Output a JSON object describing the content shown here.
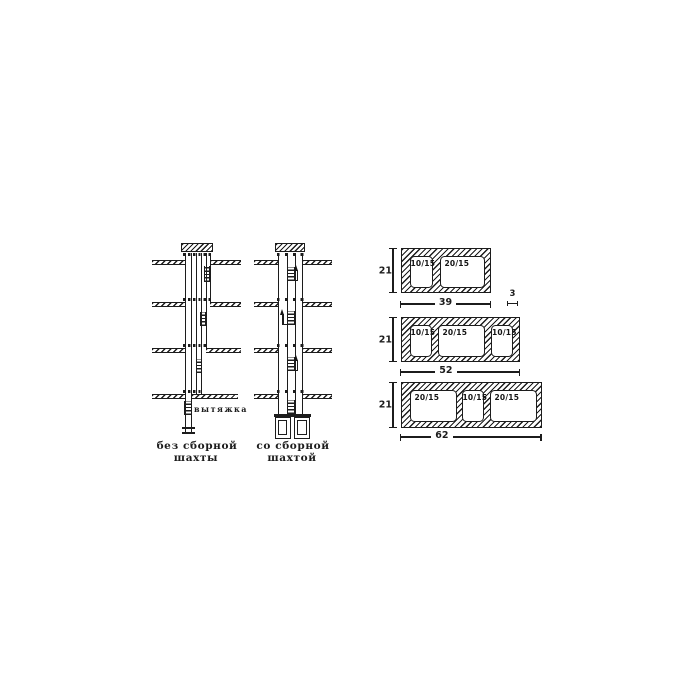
{
  "diagrams": {
    "left": {
      "exhaust_label": "вытяжка",
      "caption_line1": "без сборной",
      "caption_line2": "шахты"
    },
    "right": {
      "caption_line1": "со сборной",
      "caption_line2": "шахтой"
    }
  },
  "blocks": [
    {
      "height": "21",
      "width": "39",
      "cells": [
        "10/15",
        "20/15"
      ],
      "wall_dim": "3"
    },
    {
      "height": "21",
      "width": "52",
      "cells": [
        "10/15",
        "20/15",
        "10/15"
      ]
    },
    {
      "height": "21",
      "width": "62",
      "cells": [
        "20/15",
        "10/15",
        "20/15"
      ]
    }
  ]
}
